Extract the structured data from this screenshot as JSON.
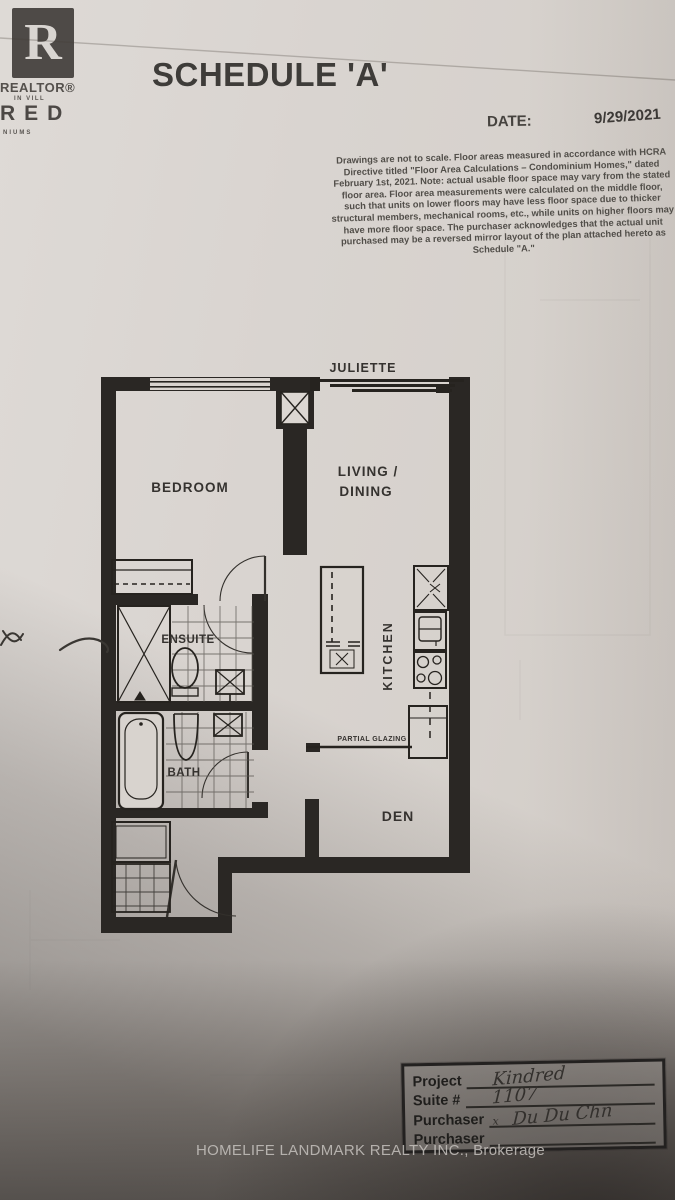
{
  "header": {
    "logo": {
      "realtor_r": "R",
      "realtor_caption": "REALTOR®",
      "brand_top_fragment": "IN VILL",
      "brand_fragment": "RED",
      "brand_bottom_fragment": "NIUMS"
    },
    "title": "SCHEDULE 'A'",
    "date_label": "DATE:",
    "date_value": "9/29/2021"
  },
  "disclaimer": "Drawings are not to scale. Floor areas measured in accordance with HCRA Directive titled \"Floor Area Calculations – Condominium Homes,\" dated February 1st, 2021. Note: actual usable floor space may vary from the stated floor area. Floor area measurements were calculated on the middle floor, such that units on lower floors may have less floor space due to thicker structural members, mechanical rooms, etc., while units on higher floors may have more floor space. The purchaser acknowledges that the actual unit purchased may be a reversed mirror layout of the plan attached hereto as Schedule \"A.\"",
  "floor_plan": {
    "labels": {
      "juliette": "JULIETTE",
      "bedroom": "BEDROOM",
      "living_line1": "LIVING /",
      "living_line2": "DINING",
      "kitchen": "KITCHEN",
      "ensuite": "ENSUITE",
      "bath": "BATH",
      "den": "DEN",
      "partial_glazing": "PARTIAL GLAZING"
    }
  },
  "form": {
    "rows": [
      {
        "label": "Project",
        "value": "Kindred"
      },
      {
        "label": "Suite #",
        "value": "1107"
      },
      {
        "label": "Purchaser",
        "prefix": "x",
        "value": "Du Du Chn"
      },
      {
        "label": "Purchaser",
        "value": ""
      }
    ]
  },
  "footer": {
    "brokerage": "HOMELIFE LANDMARK REALTY INC., Brokerage"
  }
}
